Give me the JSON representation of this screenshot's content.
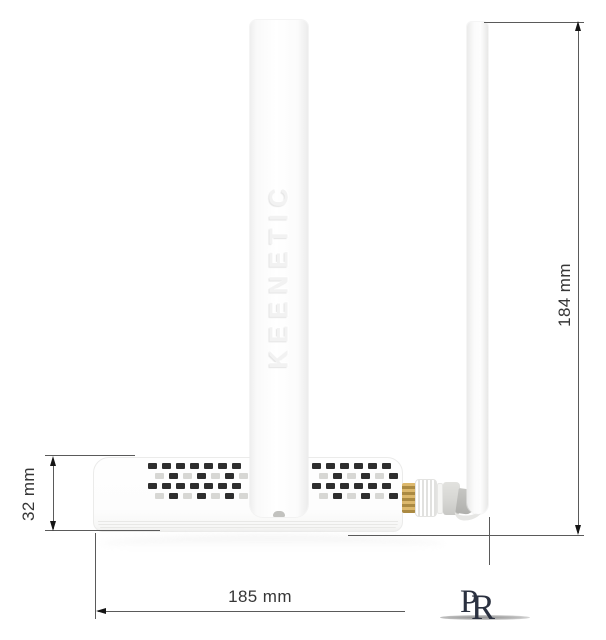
{
  "dimensions": {
    "body_height_label": "32 mm",
    "total_height_label": "184 mm",
    "width_label": "185 mm"
  },
  "device": {
    "brand_embossed": "KEENETIC",
    "vents": {
      "rows": 4,
      "left_cells": 7,
      "right_cells": 6,
      "dark_color": "#2e2e2e",
      "light_color": "#d7d7d4"
    }
  },
  "watermark": {
    "letter_p": "P",
    "letter_r": "R"
  }
}
